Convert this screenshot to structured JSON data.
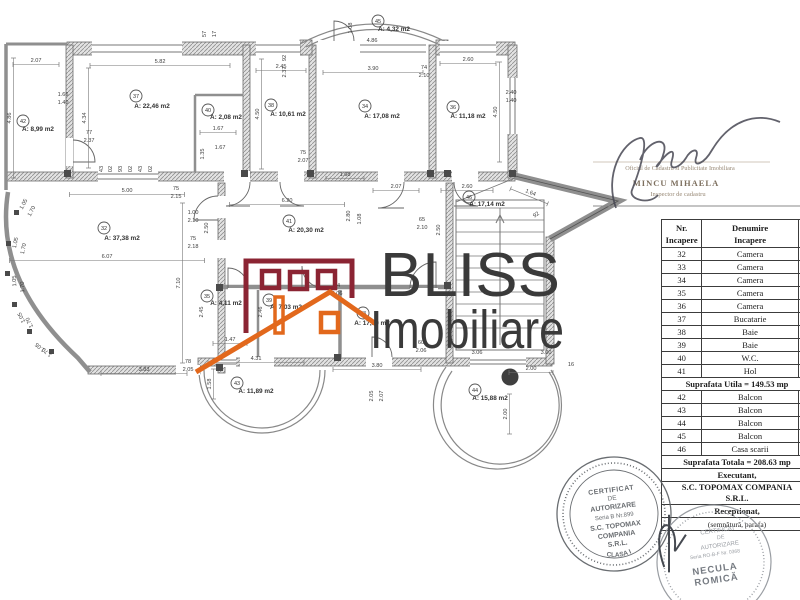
{
  "logo": {
    "line1": "BLISS",
    "line2": "Imobiliare",
    "maroon": "#8b2433",
    "orange": "#e2681c",
    "text_color": "#3a3a3a"
  },
  "table": {
    "header_col1": "Nr.\nIncapere",
    "header_col2": "Denumire\nIncapere",
    "rows": [
      {
        "nr": "32",
        "name": "Camera"
      },
      {
        "nr": "33",
        "name": "Camera"
      },
      {
        "nr": "34",
        "name": "Camera"
      },
      {
        "nr": "35",
        "name": "Camera"
      },
      {
        "nr": "36",
        "name": "Camera"
      },
      {
        "nr": "37",
        "name": "Bucatarie"
      },
      {
        "nr": "38",
        "name": "Baie"
      },
      {
        "nr": "39",
        "name": "Baie"
      },
      {
        "nr": "40",
        "name": "W.C."
      },
      {
        "nr": "41",
        "name": "Hol"
      }
    ],
    "subtotal": "Suprafata Utila = 149.53 mp",
    "rows2": [
      {
        "nr": "42",
        "name": "Balcon"
      },
      {
        "nr": "43",
        "name": "Balcon"
      },
      {
        "nr": "44",
        "name": "Balcon"
      },
      {
        "nr": "45",
        "name": "Balcon"
      },
      {
        "nr": "46",
        "name": "Casa scarii"
      }
    ],
    "total": "Suprafata Totala = 208.63 mp",
    "executant_label": "Executant,",
    "executant_name": [
      "S.C. TOPOMAX COMPANIA",
      "S.R.L."
    ],
    "receptionat_label": "Receptionat,",
    "receptionat_note": "(semnătură, parafa)"
  },
  "stamps": {
    "inspector": {
      "line1": "Oficiul de Cadastru si Publicitate Imobiliara",
      "name": "MINCU MIHAELA",
      "role": "Inspector de cadastru",
      "ink": "#8a7a68"
    },
    "topomax": {
      "l1": "CERTIFICAT",
      "l2": "DE",
      "l3": "AUTORIZARE",
      "l4": "Seria B Nr.899",
      "l5": "S.C. TOPOMAX",
      "l6": "COMPANIA",
      "l7": "S.R.L.",
      "bottom": "CLASA I",
      "ink": "#5d6165"
    },
    "necula": {
      "l1": "CERTIFICAT",
      "l2": "DE",
      "l3": "AUTORIZARE",
      "serial": "Seria RO-B-F Nr. 0368",
      "name1": "NECULA",
      "name2": "ROMICĂ",
      "arc_bottom": "Categoria B",
      "ink": "#94989e"
    }
  },
  "floorplan": {
    "rooms": [
      {
        "nr": "32",
        "area": "A: 37,38 m2",
        "cx": 104,
        "cy": 228,
        "tx": 122,
        "ty": 240
      },
      {
        "nr": "33",
        "area": "A: 17,30 m2",
        "cx": 363,
        "cy": 313,
        "tx": 372,
        "ty": 325
      },
      {
        "nr": "34",
        "area": "A: 17,08 m2",
        "cx": 365,
        "cy": 106,
        "tx": 382,
        "ty": 118
      },
      {
        "nr": "35",
        "area": "A: 4,11 m2",
        "cx": 207,
        "cy": 296,
        "tx": 226,
        "ty": 305
      },
      {
        "nr": "36",
        "area": "A: 11,18 m2",
        "cx": 453,
        "cy": 107,
        "tx": 468,
        "ty": 118
      },
      {
        "nr": "37",
        "area": "A: 22,46 m2",
        "cx": 136,
        "cy": 96,
        "tx": 152,
        "ty": 108
      },
      {
        "nr": "38",
        "area": "A: 10,61 m2",
        "cx": 271,
        "cy": 105,
        "tx": 288,
        "ty": 116
      },
      {
        "nr": "39",
        "area": "A: 7,03 m2",
        "cx": 269,
        "cy": 300,
        "tx": 286,
        "ty": 309
      },
      {
        "nr": "40",
        "area": "A: 2,08 m2",
        "cx": 208,
        "cy": 110,
        "tx": 226,
        "ty": 119
      },
      {
        "nr": "41",
        "area": "A: 20,30 m2",
        "cx": 289,
        "cy": 221,
        "tx": 306,
        "ty": 232
      },
      {
        "nr": "42",
        "area": "A: 8,99 m2",
        "cx": 23,
        "cy": 121,
        "tx": 38,
        "ty": 131
      },
      {
        "nr": "43",
        "area": "A: 11,89 m2",
        "cx": 237,
        "cy": 383,
        "tx": 256,
        "ty": 393
      },
      {
        "nr": "44",
        "area": "A: 15,88 m2",
        "cx": 475,
        "cy": 390,
        "tx": 490,
        "ty": 400
      },
      {
        "nr": "45",
        "area": "A: 4,32 m2",
        "cx": 378,
        "cy": 21,
        "tx": 394,
        "ty": 31
      },
      {
        "nr": "46",
        "area": "A: 17,14 m2",
        "cx": 469,
        "cy": 197,
        "tx": 487,
        "ty": 206
      }
    ],
    "dimensions": [
      {
        "t": "2.07",
        "x": 36,
        "y": 62,
        "len": 46
      },
      {
        "t": "5.82",
        "x": 160,
        "y": 63,
        "len": 140
      },
      {
        "t": "2.45",
        "x": 281,
        "y": 68,
        "len": 50
      },
      {
        "t": "3.90",
        "x": 373,
        "y": 70,
        "len": 100
      },
      {
        "t": "2.60",
        "x": 468,
        "y": 61,
        "len": 56
      },
      {
        "t": "4.86",
        "x": 372,
        "y": 42
      },
      {
        "t": "1.08",
        "x": 352,
        "y": 28,
        "r": -90
      },
      {
        "t": "57",
        "x": 206,
        "y": 34,
        "r": -90
      },
      {
        "t": "17",
        "x": 216,
        "y": 34,
        "r": -90
      },
      {
        "t": "4.86",
        "x": 11,
        "y": 118,
        "r": -90,
        "len": 120
      },
      {
        "t": "1.66",
        "x": 63,
        "y": 96
      },
      {
        "t": "1.40",
        "x": 63,
        "y": 104
      },
      {
        "t": "4.34",
        "x": 86,
        "y": 118,
        "r": -90,
        "len": 100
      },
      {
        "t": "4.50",
        "x": 259,
        "y": 114,
        "r": -90,
        "len": 110
      },
      {
        "t": "2.40",
        "x": 511,
        "y": 94
      },
      {
        "t": "1.40",
        "x": 511,
        "y": 102
      },
      {
        "t": "4.50",
        "x": 497,
        "y": 112,
        "r": -90,
        "len": 100
      },
      {
        "t": "92",
        "x": 286,
        "y": 58,
        "r": -90
      },
      {
        "t": "2.37",
        "x": 286,
        "y": 72,
        "r": -90
      },
      {
        "t": "74",
        "x": 424,
        "y": 69
      },
      {
        "t": "2.10",
        "x": 424,
        "y": 77
      },
      {
        "t": "77",
        "x": 89,
        "y": 134
      },
      {
        "t": "2.37",
        "x": 89,
        "y": 142
      },
      {
        "t": "1.67",
        "x": 218,
        "y": 130,
        "len": 36
      },
      {
        "t": "1.35",
        "x": 204,
        "y": 154,
        "r": -90
      },
      {
        "t": "1.67",
        "x": 220,
        "y": 149
      },
      {
        "t": "43",
        "x": 103,
        "y": 169,
        "r": -90
      },
      {
        "t": "02",
        "x": 112,
        "y": 169,
        "r": -90
      },
      {
        "t": "93",
        "x": 122,
        "y": 169,
        "r": -90
      },
      {
        "t": "02",
        "x": 132,
        "y": 169,
        "r": -90
      },
      {
        "t": "43",
        "x": 142,
        "y": 169,
        "r": -90
      },
      {
        "t": "02",
        "x": 152,
        "y": 169,
        "r": -90
      },
      {
        "t": "75",
        "x": 303,
        "y": 154
      },
      {
        "t": "2.07",
        "x": 303,
        "y": 162
      },
      {
        "t": "1.68",
        "x": 345,
        "y": 176,
        "len": 38
      },
      {
        "t": "2.07",
        "x": 396,
        "y": 188,
        "len": 46
      },
      {
        "t": "2.60",
        "x": 467,
        "y": 188,
        "len": 52
      },
      {
        "t": "1.64",
        "x": 530,
        "y": 194,
        "r": 22,
        "len": 40
      },
      {
        "t": "92",
        "x": 537,
        "y": 216,
        "r": -35
      },
      {
        "t": "5.00",
        "x": 127,
        "y": 192,
        "len": 115
      },
      {
        "t": "75",
        "x": 176,
        "y": 190
      },
      {
        "t": "2.15",
        "x": 176,
        "y": 198
      },
      {
        "t": "6.20",
        "x": 287,
        "y": 202,
        "len": 115
      },
      {
        "t": "1.00",
        "x": 193,
        "y": 214
      },
      {
        "t": "2.10",
        "x": 193,
        "y": 222
      },
      {
        "t": "2.50",
        "x": 208,
        "y": 228,
        "r": -90
      },
      {
        "t": "75",
        "x": 193,
        "y": 240
      },
      {
        "t": "2.18",
        "x": 193,
        "y": 248
      },
      {
        "t": "2.80",
        "x": 350,
        "y": 216,
        "r": -90
      },
      {
        "t": "1.08",
        "x": 361,
        "y": 219,
        "r": -90
      },
      {
        "t": "65",
        "x": 422,
        "y": 221
      },
      {
        "t": "2.10",
        "x": 422,
        "y": 229
      },
      {
        "t": "2.50",
        "x": 440,
        "y": 230,
        "r": -90
      },
      {
        "t": "6.07",
        "x": 107,
        "y": 258,
        "len": 195
      },
      {
        "t": "7.10",
        "x": 180,
        "y": 283,
        "r": -90,
        "len": 160
      },
      {
        "t": "1.05",
        "x": 25,
        "y": 205,
        "r": -62
      },
      {
        "t": "1.70",
        "x": 33,
        "y": 212,
        "r": -62
      },
      {
        "t": "1.05",
        "x": 17,
        "y": 243,
        "r": -78
      },
      {
        "t": "1.70",
        "x": 25,
        "y": 249,
        "r": -78
      },
      {
        "t": "1.05",
        "x": 16,
        "y": 281,
        "r": -92
      },
      {
        "t": "1.70",
        "x": 24,
        "y": 287,
        "r": -92
      },
      {
        "t": "1.05",
        "x": 23,
        "y": 317,
        "r": -115
      },
      {
        "t": "1.70",
        "x": 31,
        "y": 322,
        "r": -115
      },
      {
        "t": "1.05",
        "x": 41,
        "y": 346,
        "r": -140
      },
      {
        "t": "1.70",
        "x": 48,
        "y": 351,
        "r": -140
      },
      {
        "t": "2.45",
        "x": 203,
        "y": 312,
        "r": -90
      },
      {
        "t": "2.46",
        "x": 262,
        "y": 312,
        "r": -90
      },
      {
        "t": "1.47",
        "x": 230,
        "y": 341,
        "len": 34
      },
      {
        "t": "74",
        "x": 337,
        "y": 287
      },
      {
        "t": "2.06",
        "x": 337,
        "y": 295
      },
      {
        "t": "60",
        "x": 421,
        "y": 344
      },
      {
        "t": "2.06",
        "x": 421,
        "y": 352
      },
      {
        "t": "3.83",
        "x": 144,
        "y": 371,
        "len": 86
      },
      {
        "t": "78",
        "x": 188,
        "y": 363
      },
      {
        "t": "2.05",
        "x": 188,
        "y": 371
      },
      {
        "t": "4.31",
        "x": 256,
        "y": 360,
        "len": 96
      },
      {
        "t": "1.58",
        "x": 211,
        "y": 384,
        "r": -90,
        "len": 30
      },
      {
        "t": "3.80",
        "x": 377,
        "y": 367,
        "len": 88
      },
      {
        "t": "2.05",
        "x": 373,
        "y": 396,
        "r": -90
      },
      {
        "t": "2.07",
        "x": 383,
        "y": 396,
        "r": -90
      },
      {
        "t": "3.06",
        "x": 477,
        "y": 354
      },
      {
        "t": "3.00",
        "x": 546,
        "y": 354
      },
      {
        "t": "2.00",
        "x": 531,
        "y": 370,
        "len": 44
      },
      {
        "t": "16",
        "x": 571,
        "y": 366
      },
      {
        "t": "2.00",
        "x": 507,
        "y": 414,
        "r": -90,
        "len": 40
      }
    ]
  }
}
